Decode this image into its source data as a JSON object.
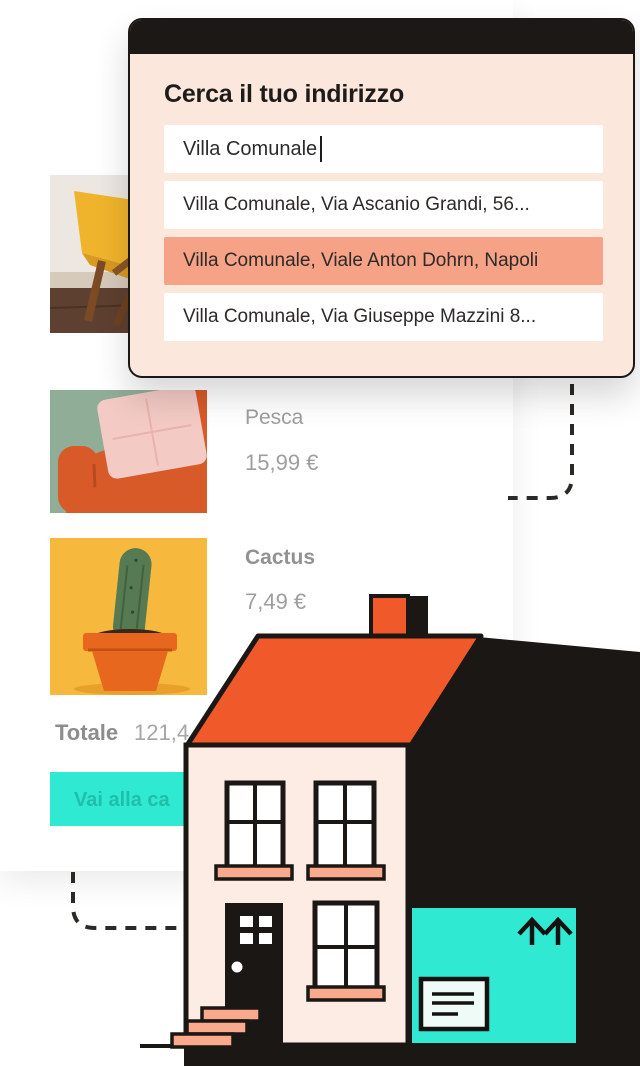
{
  "modal": {
    "title": "Cerca il tuo indirizzo",
    "search": {
      "value": "Villa Comunale"
    },
    "suggestions": [
      {
        "label": "Villa Comunale, Via Ascanio Grandi, 56...",
        "highlighted": false
      },
      {
        "label": "Villa Comunale, Viale Anton Dohrn, Napoli",
        "highlighted": true
      },
      {
        "label": "Villa Comunale, Via Giuseppe Mazzini 8...",
        "highlighted": false
      }
    ]
  },
  "cart": {
    "items": [
      {
        "image": "yellow-chair-photo"
      },
      {
        "name": "Pesca",
        "price": "15,99 €",
        "image": "orange-sofa-photo"
      },
      {
        "name": "Cactus",
        "price": "7,49 €",
        "image": "cactus-pot-photo"
      }
    ],
    "total_label": "Totale",
    "total_value": "121,4",
    "checkout_label": "Vai alla ca"
  },
  "icons": {
    "garage_arrows": "up-arrows-icon",
    "garage_label": "shipping-label-icon"
  },
  "colors": {
    "accent_teal": "#2fe9d2",
    "highlight_salmon": "#f5a287",
    "modal_bg": "#fce7dc",
    "header_black": "#1b1815",
    "roof_orange": "#f05a2b",
    "wall_pink": "#fdece3",
    "sill_salmon": "#f9a98c",
    "ink_black": "#1a1714",
    "muted_text": "#9e9e9e"
  }
}
